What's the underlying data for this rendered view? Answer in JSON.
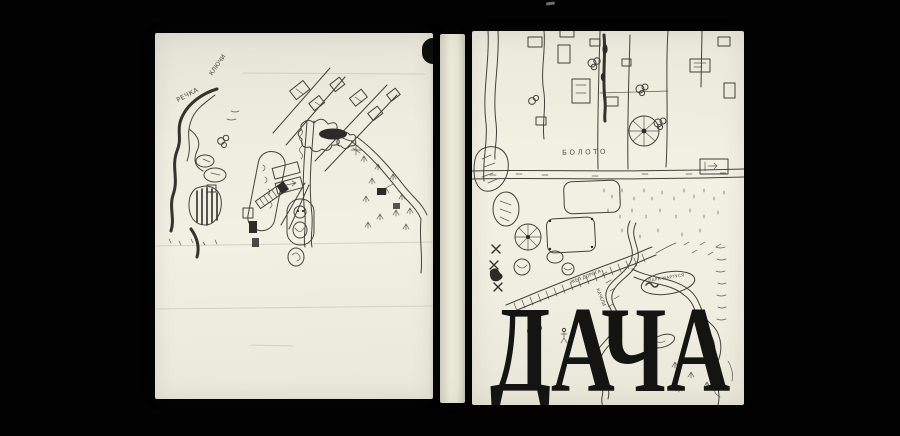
{
  "scene": {
    "background_color": "#000000",
    "paper_color": "#f0eee1",
    "ink_color": "#34332c",
    "title_color": "#141413"
  },
  "front_cover": {
    "title": "ДАЧА",
    "labels": [
      {
        "id": "boloto",
        "text": "БОЛОТО"
      },
      {
        "id": "park",
        "text": "ПАРК МАРТУСЯ"
      },
      {
        "id": "doroga",
        "text": "ЖЕЛ ДОРОГА"
      },
      {
        "id": "kacheli",
        "text": "КАЧЕЛИ"
      }
    ]
  },
  "back_cover": {
    "labels": [
      {
        "id": "rechka",
        "text": "РЕЧКА"
      },
      {
        "id": "klyuchi",
        "text": "КЛЮЧИ"
      }
    ]
  }
}
